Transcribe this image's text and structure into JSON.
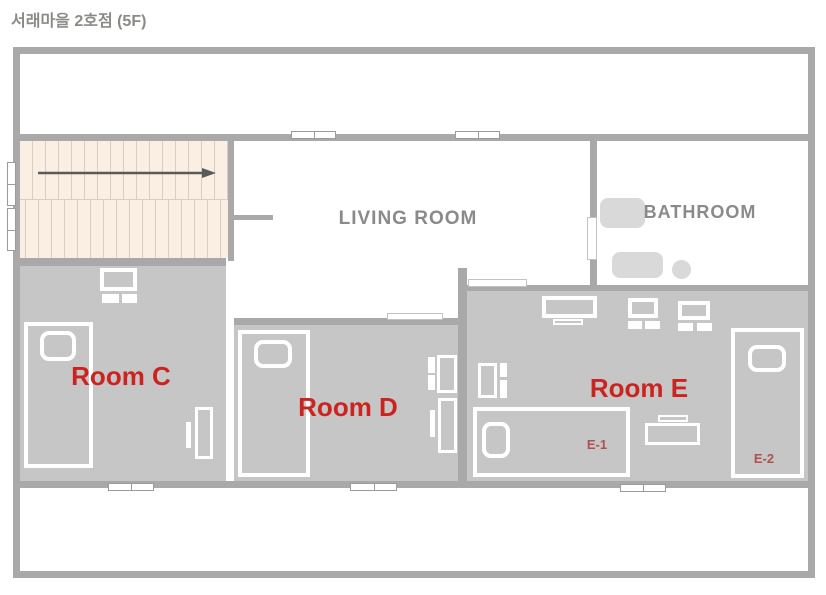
{
  "title": "서래마을 2호점 (5F)",
  "labels": {
    "living_room": "LIVING ROOM",
    "bathroom": "BATHROOM",
    "room_c": "Room C",
    "room_d": "Room D",
    "room_e": "Room E",
    "bed_e1": "E-1",
    "bed_e2": "E-2"
  },
  "rooms": [
    {
      "name": "Living Room",
      "furniture": []
    },
    {
      "name": "Bathroom",
      "furniture": [
        "sink",
        "bathtub",
        "toilet"
      ]
    },
    {
      "name": "Room C",
      "furniture": [
        "bed",
        "monitor",
        "keyboard",
        "desk",
        "chair"
      ]
    },
    {
      "name": "Room D",
      "furniture": [
        "bed",
        "desk",
        "desk",
        "chair"
      ]
    },
    {
      "name": "Room E",
      "furniture": [
        "monitor",
        "monitor",
        "monitor",
        "desk",
        "bed E-1",
        "bed E-2",
        "desk",
        "chair"
      ]
    }
  ],
  "stairs": {
    "direction": "right",
    "location": "top-left"
  },
  "colors": {
    "wall": "#a9a9a9",
    "room_fill": "#c6c6c6",
    "fixture": "#d9d9d9",
    "stairs_bg": "#fbeee2",
    "stairs_line": "#d8cec4",
    "arrow": "#5a5a5a",
    "label_gray": "#8a8a8a",
    "label_red": "#cb2420",
    "bed_label_red": "#b25050",
    "title_gray": "#8b8b86"
  }
}
